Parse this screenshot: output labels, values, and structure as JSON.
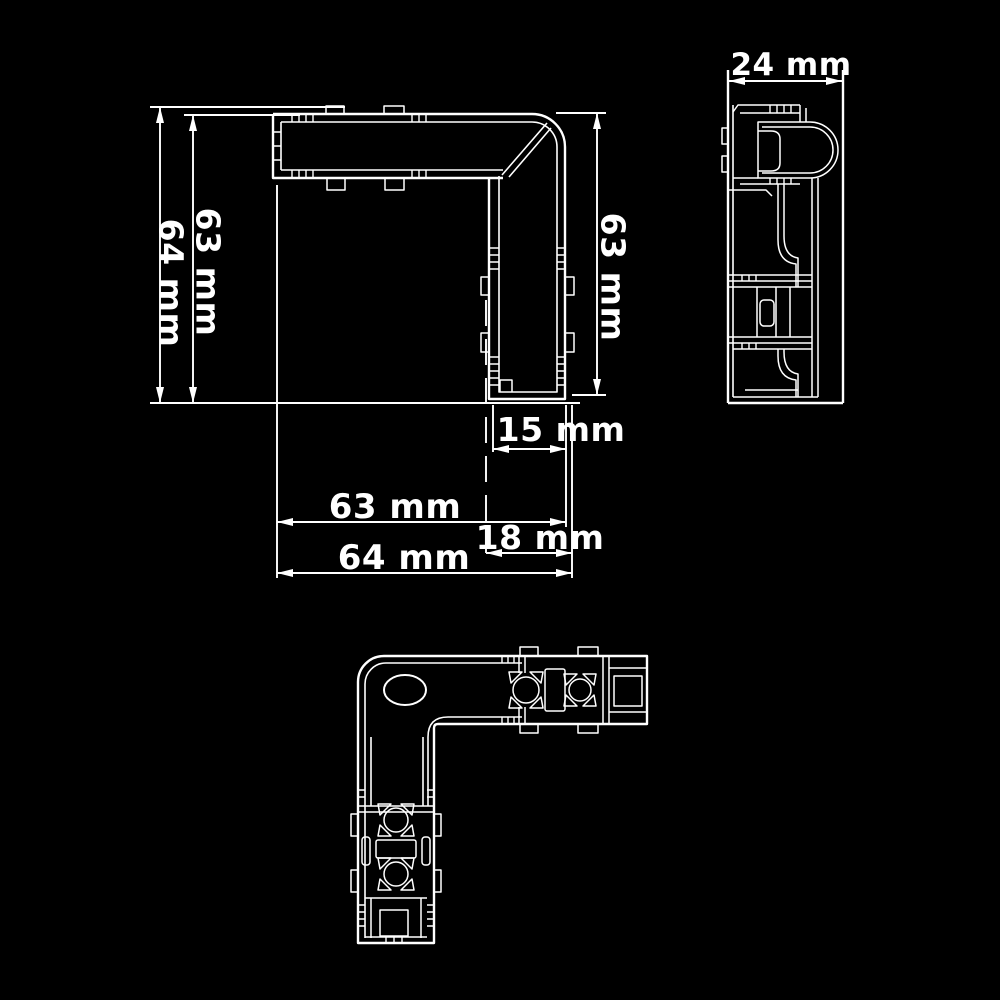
{
  "colors": {
    "background": "#000000",
    "line": "#ffffff"
  },
  "dimensions": {
    "front_left_outer_height": "64 mm",
    "front_left_inner_height": "63 mm",
    "front_right_height": "63 mm",
    "leg_inner_width": "15 mm",
    "front_inner_width": "63 mm",
    "leg_outer_width": "18 mm",
    "front_outer_width": "64 mm",
    "side_width": "24 mm"
  }
}
